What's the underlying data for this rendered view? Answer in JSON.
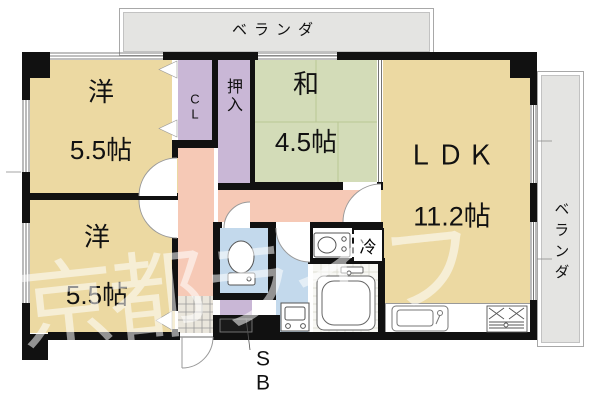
{
  "plan": {
    "verandas": {
      "top_label": "ベランダ",
      "right_label": "ベランダ"
    },
    "rooms": {
      "western_top": {
        "name": "洋",
        "size": "5.5帖"
      },
      "western_bottom": {
        "name": "洋",
        "size": "5.5帖"
      },
      "japanese": {
        "name": "和",
        "size": "4.5帖"
      },
      "ldk": {
        "name": "ＬＤＫ",
        "size": "11.2帖"
      },
      "closet_label": "C\nL",
      "oshiire_label": "押\n入"
    },
    "fixtures": {
      "refrigerator_label": "冷",
      "shoe_box_label": "S\nB"
    },
    "watermark": "京都ライフ",
    "colors": {
      "room_tan": "#ecd9a2",
      "tatami_green": "#d3dcb8",
      "closet_purple": "#c9b7d6",
      "hall_pink": "#f6c9b6",
      "water_blue": "#c3d9ec",
      "veranda_gray": "#e4e4e2",
      "wall": "#111111"
    }
  }
}
